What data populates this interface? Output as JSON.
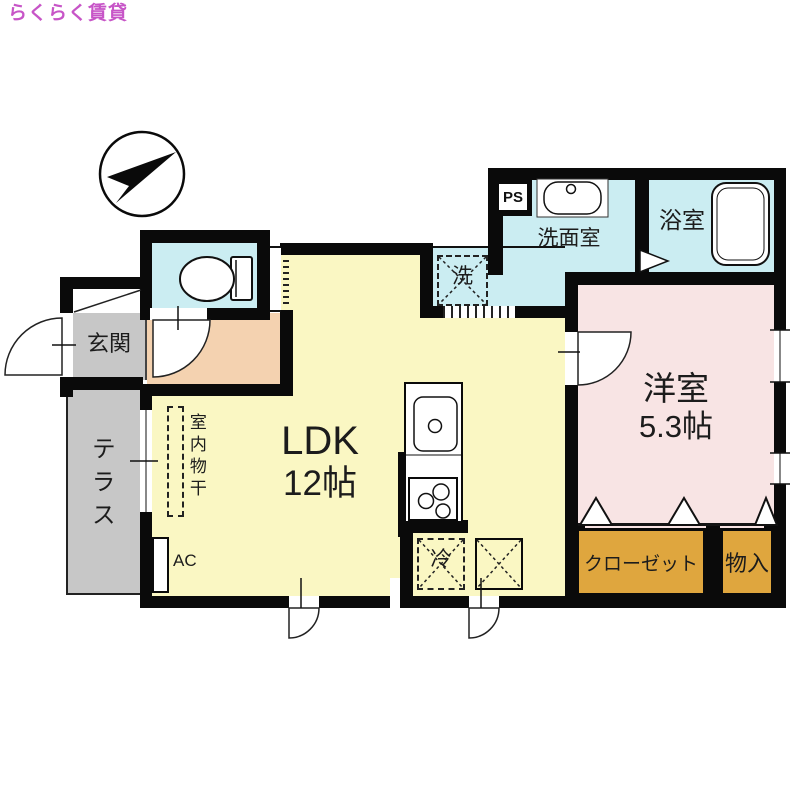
{
  "logo": {
    "text": "らくらく賃貸"
  },
  "icons": {
    "compass": "compass-north-arrow",
    "toilet": "toilet-icon",
    "bathtub": "bathtub-icon",
    "washbasin": "washbasin-icon",
    "kitchen_sink": "kitchen-sink-icon",
    "stove": "stove-burners-icon"
  },
  "rooms": {
    "ldk": {
      "name": "LDK",
      "size": "12帖"
    },
    "western_room": {
      "name": "洋室",
      "size": "5.3帖"
    },
    "washroom": {
      "name": "洗面室"
    },
    "bathroom": {
      "name": "浴室"
    },
    "entrance": {
      "name": "玄関"
    },
    "terrace": {
      "name": "テラス"
    },
    "closet": {
      "name": "クローゼット"
    },
    "storage": {
      "name": "物入"
    }
  },
  "labels": {
    "ps": "PS",
    "washing_machine": "洗",
    "refrigerator": "冷",
    "air_conditioner": "AC",
    "indoor_drying": "室内物干"
  },
  "colors": {
    "logo": "#C755C7",
    "wall": "#0A0A0A",
    "ldk_fill": "#FAF7C3",
    "water_fill": "#CBEDF2",
    "western_fill": "#F8E4E4",
    "hall_fill": "#F4D2B0",
    "gray_fill": "#C7C7C7",
    "closet_fill": "#DFA63E"
  }
}
